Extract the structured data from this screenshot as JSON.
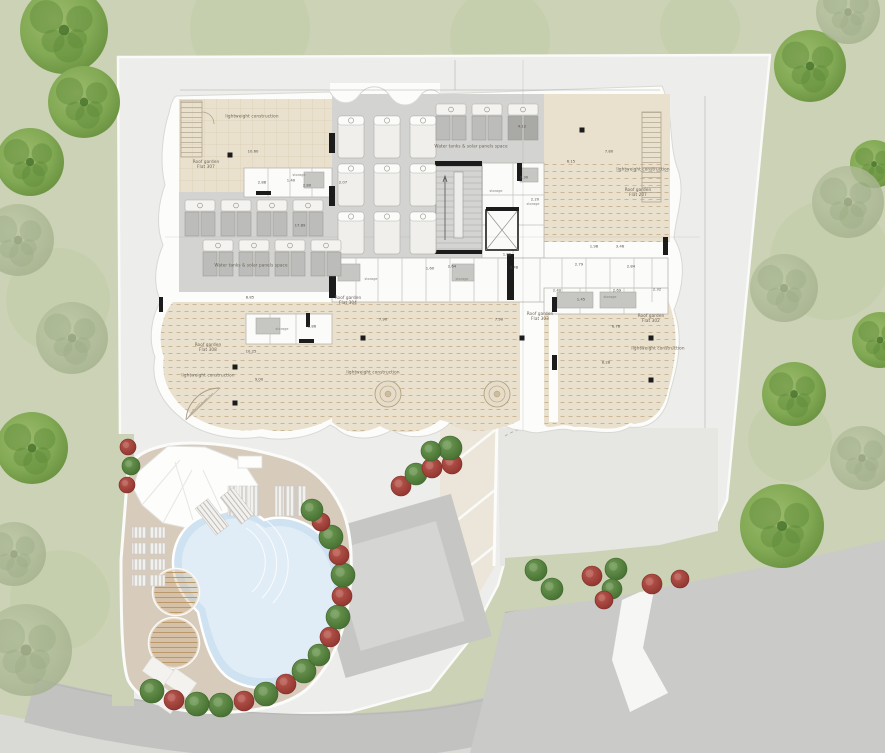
{
  "document": {
    "kind": "architectural roof / site plan",
    "storage_text": "storage"
  },
  "colors": {
    "grass": "#cbd2b5",
    "grass_blob": "#c2cca6",
    "plot": "#ededeb",
    "plot_panel": "#e6e6e3",
    "building_white": "#fcfcfb",
    "garden_beige": "#e9e0cd",
    "hatch": "#c2ab87",
    "grid_hatch": "#d8c9ac",
    "deck_gray": "#d3d3d1",
    "panel_gray": "#bcbcba",
    "road_gray": "#c2c2c0",
    "road_light": "#d9d9d6",
    "driveway": "#cacac8",
    "pool_deck_tan": "#d7cbbc",
    "pool_water": "#cfe2f1",
    "pool_water_light": "#e4eef7",
    "wood": "#cfae80",
    "tree_bright_a": "#8db05c",
    "tree_bright_b": "#5e8a38",
    "tree_faded_a": "#b5c0a1",
    "tree_faded_b": "#9cab85",
    "bush_green": "#55833f",
    "bush_green_dark": "#3c6629",
    "bush_red": "#a8403a",
    "bush_red_dark": "#7e2b27",
    "black": "#1c1c1c"
  },
  "plan_labels": [
    {
      "t": "lightweight construction",
      "x": 252,
      "y": 116,
      "s": 4.2,
      "w": 80
    },
    {
      "t": "Roof garden\nFlat 307",
      "x": 206,
      "y": 164,
      "s": 4.2,
      "w": 44
    },
    {
      "t": "Water tanks & solar panels space",
      "x": 471,
      "y": 146,
      "s": 4.2,
      "w": 130
    },
    {
      "t": "lightweight construction",
      "x": 643,
      "y": 169,
      "s": 4.2,
      "w": 80
    },
    {
      "t": "Roof garden\nFlat 207",
      "x": 638,
      "y": 192,
      "s": 4.2,
      "w": 44
    },
    {
      "t": "Water tanks & solar panels space",
      "x": 251,
      "y": 265,
      "s": 4.2,
      "w": 130
    },
    {
      "t": "Roof garden\nFlat 308",
      "x": 208,
      "y": 347,
      "s": 4.2,
      "w": 44
    },
    {
      "t": "lightweight construction",
      "x": 208,
      "y": 375,
      "s": 4.2,
      "w": 80
    },
    {
      "t": "Roof garden\nFlat 304",
      "x": 348,
      "y": 300,
      "s": 4.2,
      "w": 44
    },
    {
      "t": "lightweight construction",
      "x": 373,
      "y": 372,
      "s": 4.2,
      "w": 80
    },
    {
      "t": "Roof garden\nFlat 303",
      "x": 540,
      "y": 316,
      "s": 4.2,
      "w": 44
    },
    {
      "t": "Roof garden\nFlat 302",
      "x": 651,
      "y": 318,
      "s": 4.2,
      "w": 44
    },
    {
      "t": "lightweight construction",
      "x": 658,
      "y": 348,
      "s": 4.2,
      "w": 80
    }
  ],
  "dim_labels": [
    {
      "t": "10.60",
      "x": 253,
      "y": 151
    },
    {
      "t": "2.88",
      "x": 262,
      "y": 182
    },
    {
      "t": "1.40",
      "x": 291,
      "y": 180
    },
    {
      "t": "2.80",
      "x": 307,
      "y": 185
    },
    {
      "t": "2.07",
      "x": 343,
      "y": 182
    },
    {
      "t": "4.12",
      "x": 522,
      "y": 126
    },
    {
      "t": "6.15",
      "x": 571,
      "y": 161
    },
    {
      "t": "7.80",
      "x": 609,
      "y": 151
    },
    {
      "t": "17.89",
      "x": 300,
      "y": 225
    },
    {
      "t": "8.85",
      "x": 250,
      "y": 297
    },
    {
      "t": "10.25",
      "x": 251,
      "y": 351
    },
    {
      "t": "9.00",
      "x": 259,
      "y": 379
    },
    {
      "t": "2.30",
      "x": 524,
      "y": 177
    },
    {
      "t": "2.20",
      "x": 535,
      "y": 199
    },
    {
      "t": "1.86",
      "x": 507,
      "y": 254
    },
    {
      "t": "2.48",
      "x": 514,
      "y": 267
    },
    {
      "t": "2.79",
      "x": 579,
      "y": 264
    },
    {
      "t": "2.84",
      "x": 631,
      "y": 266
    },
    {
      "t": "2.40",
      "x": 557,
      "y": 290
    },
    {
      "t": "2.69",
      "x": 617,
      "y": 290
    },
    {
      "t": "2.32",
      "x": 657,
      "y": 289
    },
    {
      "t": "1.45",
      "x": 581,
      "y": 299
    },
    {
      "t": "6.78",
      "x": 616,
      "y": 326
    },
    {
      "t": "7.90",
      "x": 383,
      "y": 319
    },
    {
      "t": "7.90",
      "x": 499,
      "y": 319
    },
    {
      "t": "8.28",
      "x": 606,
      "y": 362
    },
    {
      "t": "1.60",
      "x": 430,
      "y": 268
    },
    {
      "t": "2.64",
      "x": 452,
      "y": 266
    },
    {
      "t": "2.86",
      "x": 312,
      "y": 326
    },
    {
      "t": "3.46",
      "x": 620,
      "y": 246
    },
    {
      "t": "1.98",
      "x": 594,
      "y": 246
    }
  ],
  "storage_positions": [
    {
      "x": 496,
      "y": 191
    },
    {
      "x": 533,
      "y": 204
    },
    {
      "x": 371,
      "y": 279
    },
    {
      "x": 462,
      "y": 279
    },
    {
      "x": 610,
      "y": 297
    },
    {
      "x": 299,
      "y": 175
    },
    {
      "x": 282,
      "y": 329
    }
  ],
  "trees": [
    [
      64,
      30,
      44,
      "b"
    ],
    [
      84,
      102,
      36,
      "b"
    ],
    [
      30,
      162,
      34,
      "b"
    ],
    [
      18,
      240,
      36,
      "f"
    ],
    [
      72,
      338,
      36,
      "f"
    ],
    [
      32,
      448,
      36,
      "b"
    ],
    [
      14,
      554,
      32,
      "f"
    ],
    [
      26,
      650,
      46,
      "f"
    ],
    [
      810,
      66,
      36,
      "b"
    ],
    [
      848,
      12,
      32,
      "f"
    ],
    [
      874,
      164,
      24,
      "b"
    ],
    [
      848,
      202,
      36,
      "f"
    ],
    [
      784,
      288,
      34,
      "f"
    ],
    [
      880,
      340,
      28,
      "b"
    ],
    [
      794,
      394,
      32,
      "b"
    ],
    [
      862,
      458,
      32,
      "f"
    ],
    [
      782,
      526,
      42,
      "b"
    ]
  ],
  "bushes": [
    [
      128,
      447,
      "r",
      8
    ],
    [
      131,
      466,
      "g",
      9
    ],
    [
      127,
      485,
      "r",
      8
    ],
    [
      152,
      691,
      "g",
      12
    ],
    [
      174,
      700,
      "r",
      10
    ],
    [
      197,
      704,
      "g",
      12
    ],
    [
      221,
      705,
      "g",
      12
    ],
    [
      244,
      701,
      "r",
      10
    ],
    [
      266,
      694,
      "g",
      12
    ],
    [
      286,
      684,
      "r",
      10
    ],
    [
      304,
      671,
      "g",
      12
    ],
    [
      319,
      655,
      "g",
      11
    ],
    [
      330,
      637,
      "r",
      10
    ],
    [
      338,
      617,
      "g",
      12
    ],
    [
      342,
      596,
      "r",
      10
    ],
    [
      343,
      575,
      "g",
      12
    ],
    [
      339,
      555,
      "r",
      10
    ],
    [
      331,
      537,
      "g",
      12
    ],
    [
      321,
      522,
      "r",
      9
    ],
    [
      312,
      510,
      "g",
      11
    ],
    [
      401,
      486,
      "r",
      10
    ],
    [
      416,
      474,
      "g",
      11
    ],
    [
      432,
      468,
      "r",
      10
    ],
    [
      452,
      464,
      "r",
      10
    ],
    [
      450,
      448,
      "g",
      12
    ],
    [
      431,
      451,
      "g",
      10
    ],
    [
      536,
      570,
      "g",
      11
    ],
    [
      552,
      589,
      "g",
      11
    ],
    [
      592,
      576,
      "r",
      10
    ],
    [
      616,
      569,
      "g",
      11
    ],
    [
      612,
      589,
      "g",
      10
    ],
    [
      652,
      584,
      "r",
      10
    ],
    [
      604,
      600,
      "r",
      9
    ],
    [
      680,
      579,
      "r",
      9
    ]
  ],
  "roof_loungers": {
    "cols": [
      338,
      374,
      410
    ],
    "rows": [
      116,
      164,
      212
    ],
    "w": 26,
    "h": 42
  },
  "solar_units": {
    "top": [
      [
        436,
        104
      ],
      [
        472,
        104
      ],
      [
        508,
        104
      ]
    ],
    "mid": [
      [
        185,
        200
      ],
      [
        221,
        200
      ],
      [
        257,
        200
      ],
      [
        293,
        200
      ],
      [
        203,
        240
      ],
      [
        239,
        240
      ],
      [
        275,
        240
      ],
      [
        311,
        240
      ]
    ]
  },
  "pool_loungers": {
    "groups": [
      [
        228,
        486
      ],
      [
        275,
        486
      ]
    ],
    "tilted": [
      [
        204,
        500,
        -38
      ],
      [
        229,
        489,
        -38
      ]
    ],
    "stack": [
      [
        132,
        527
      ],
      [
        150,
        527
      ],
      [
        132,
        543
      ],
      [
        150,
        543
      ],
      [
        132,
        559
      ],
      [
        150,
        559
      ],
      [
        132,
        575
      ],
      [
        150,
        575
      ]
    ]
  },
  "paving_stones": [
    [
      145,
      662,
      35
    ],
    [
      168,
      674,
      35
    ],
    [
      152,
      690,
      35
    ]
  ],
  "black_dots": [
    [
      230,
      155
    ],
    [
      582,
      130
    ],
    [
      363,
      338
    ],
    [
      522,
      338
    ],
    [
      651,
      338
    ],
    [
      651,
      380
    ],
    [
      235,
      367
    ],
    [
      235,
      403
    ]
  ],
  "black_bars": [
    [
      329,
      133,
      6,
      20
    ],
    [
      329,
      186,
      6,
      20
    ],
    [
      435,
      161,
      47,
      5
    ],
    [
      517,
      163,
      5,
      18
    ],
    [
      486,
      207,
      33,
      4
    ],
    [
      507,
      254,
      7,
      46
    ],
    [
      329,
      254,
      7,
      44
    ],
    [
      256,
      191,
      15,
      4
    ],
    [
      299,
      339,
      15,
      4
    ],
    [
      552,
      297,
      5,
      15
    ],
    [
      552,
      355,
      5,
      15
    ],
    [
      663,
      237,
      5,
      18
    ],
    [
      159,
      297,
      4,
      15
    ],
    [
      435,
      250,
      47,
      4
    ],
    [
      306,
      313,
      4,
      14
    ]
  ]
}
